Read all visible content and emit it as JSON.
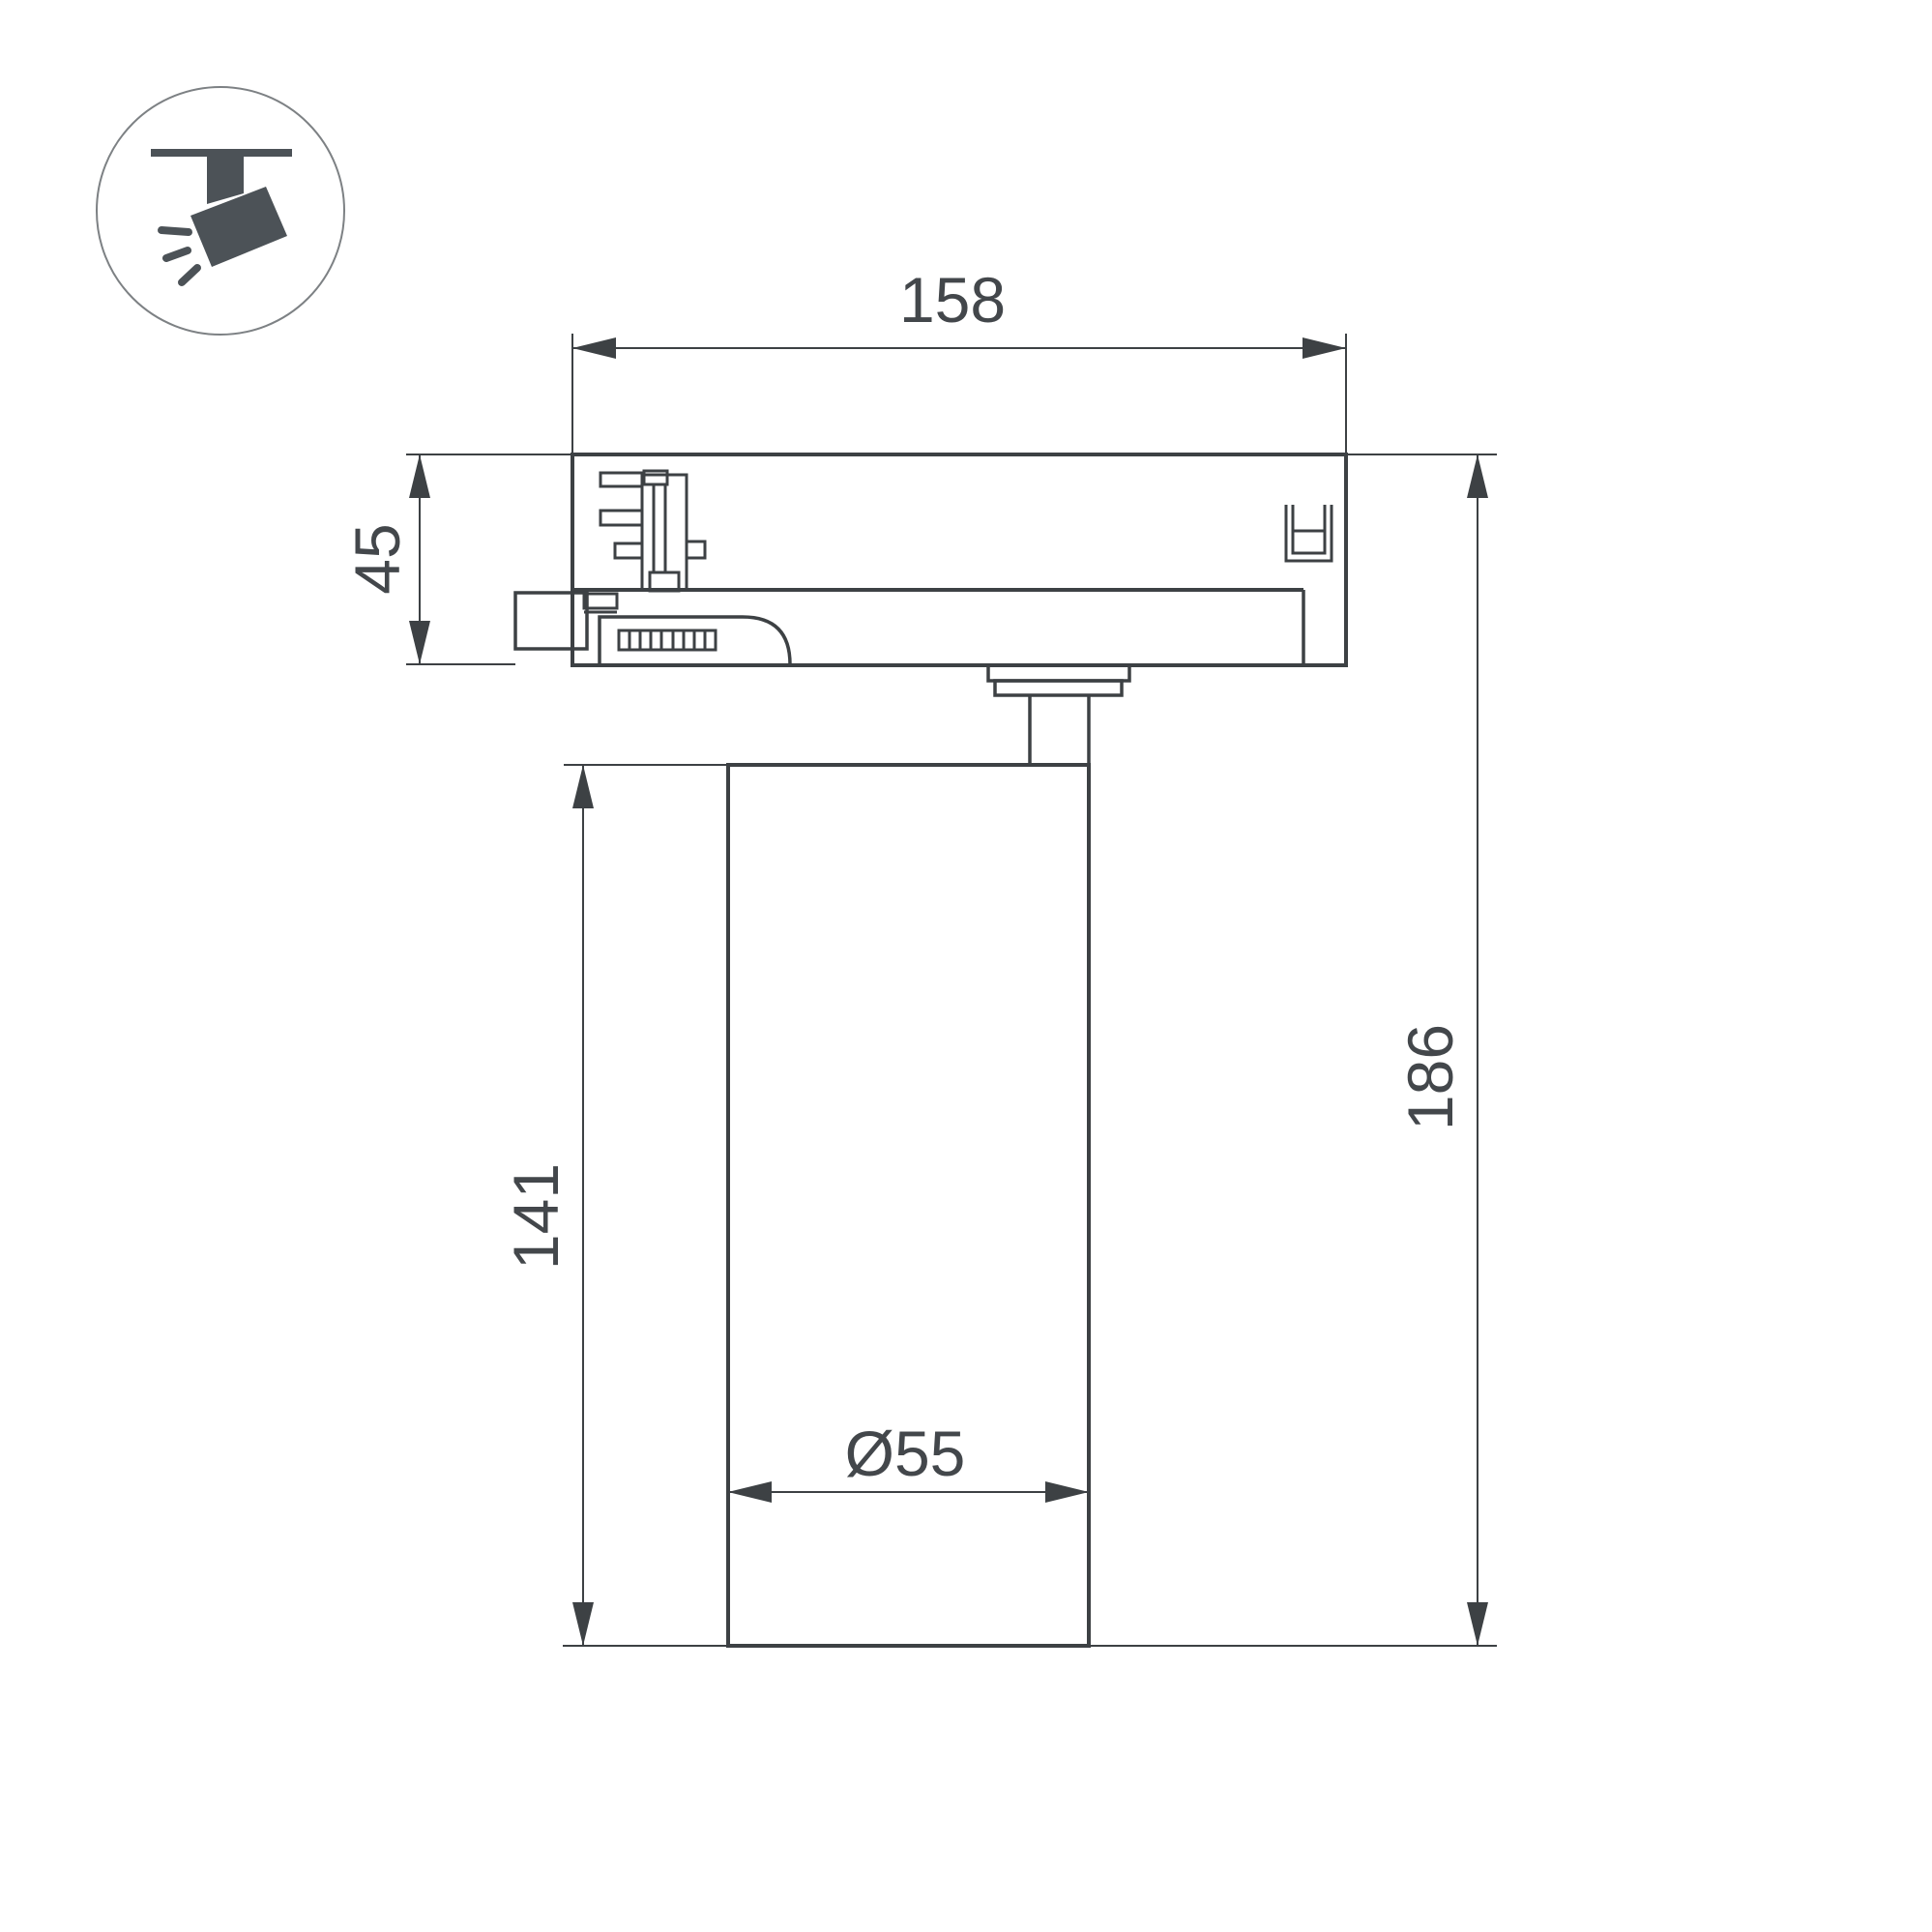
{
  "title": "track-luminaire-dimension-drawing",
  "colors": {
    "background": "#ffffff",
    "line": "#3d4144",
    "dim": "#3d4144",
    "text": "#43474b",
    "icon_glyph": "#4c5257",
    "icon_circle_stroke": "#7d8184"
  },
  "icon": {
    "name": "track-spotlight-icon"
  },
  "dimensions": {
    "track_adapter_width": "158",
    "track_adapter_height": "45",
    "body_height": "141",
    "total_height": "186",
    "body_diameter": "Ø55"
  }
}
